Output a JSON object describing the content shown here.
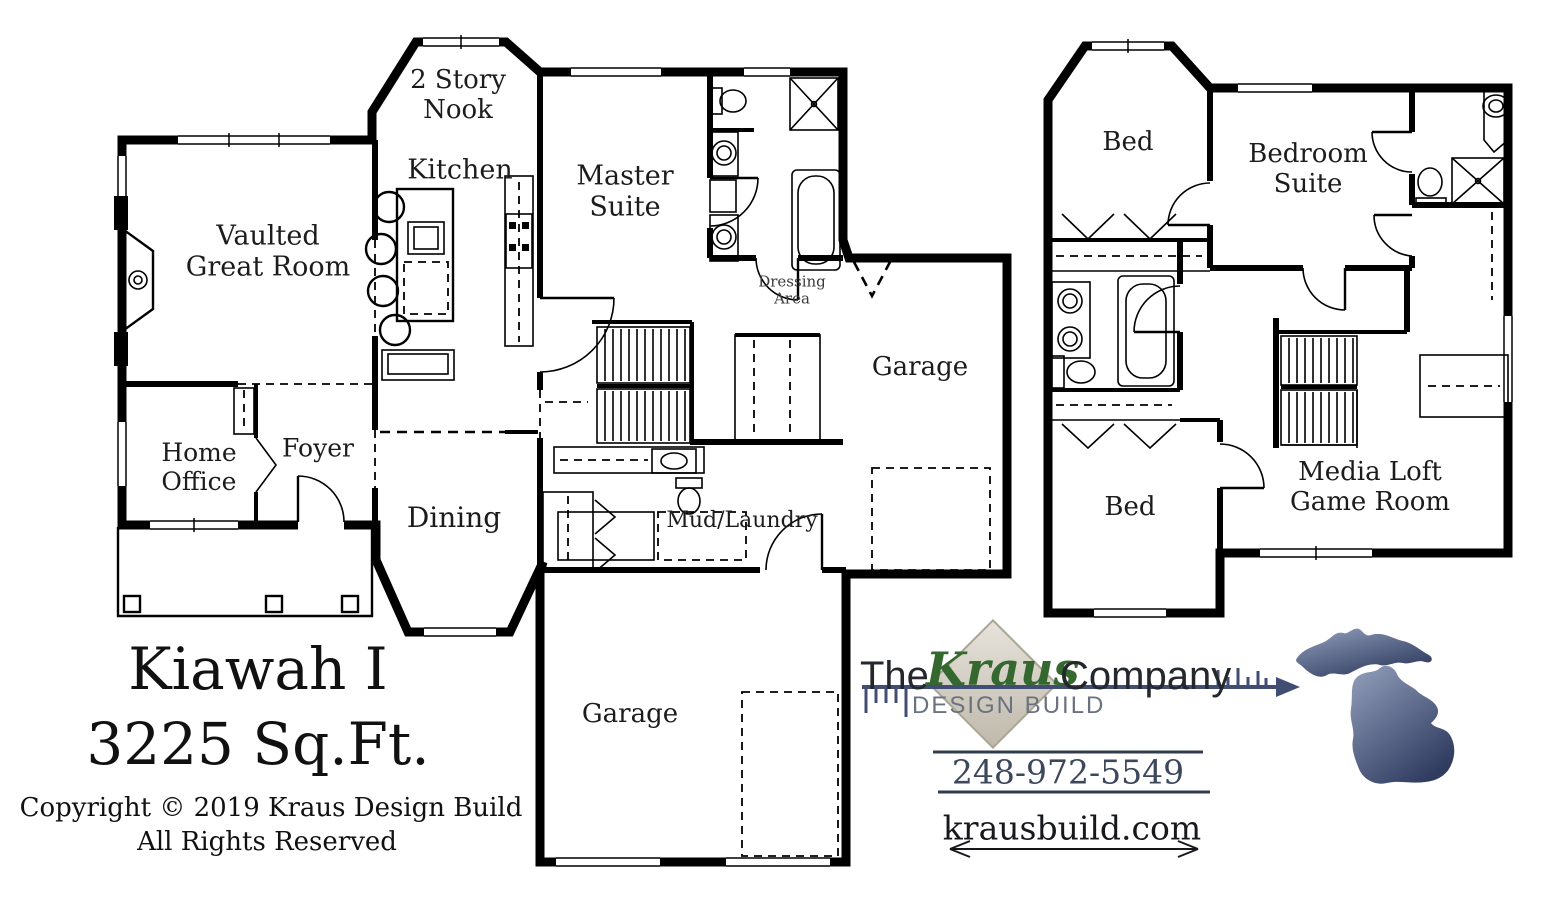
{
  "plan_title": {
    "name": "Kiawah I",
    "area": "3225 Sq.Ft.",
    "copyright1": "Copyright © 2019 Kraus Design Build",
    "copyright2": "All Rights Reserved"
  },
  "first_floor": {
    "rooms": {
      "nook": "2 Story\nNook",
      "kitchen": "Kitchen",
      "great_room": "Vaulted\nGreat Room",
      "master_suite": "Master\nSuite",
      "dressing_area": "Dressing\nArea",
      "garage_side": "Garage",
      "home_office": "Home\nOffice",
      "foyer": "Foyer",
      "dining": "Dining",
      "mud_laundry": "Mud/Laundry",
      "garage_rear": "Garage"
    }
  },
  "second_floor": {
    "rooms": {
      "bed_front": "Bed",
      "bedroom_suite": "Bedroom\nSuite",
      "bed_rear": "Bed",
      "media_loft": "Media Loft\nGame Room"
    }
  },
  "branding": {
    "company_prefix": "The",
    "company_name": "Kraus",
    "company_suffix": "Company",
    "tagline": "DESIGN BUILD",
    "phone": "248-972-5549",
    "website": "krausbuild.com"
  },
  "colors": {
    "wall": "#000000",
    "kraus_green": "#35682f",
    "logo_text": "#24272b",
    "tagline_gray": "#6a7280",
    "arrow_blue": "#414d72",
    "phone_slate": "#3c475c",
    "diamond_beige": "#d8d4ca",
    "michigan_dark": "#2f3c60",
    "michigan_light": "#93a0bd"
  }
}
